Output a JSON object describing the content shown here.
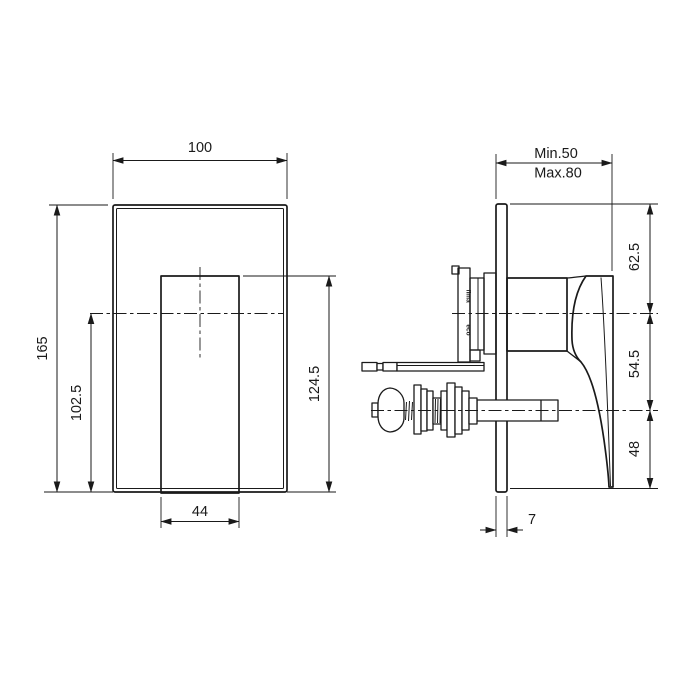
{
  "page": {
    "background_color": "#ffffff",
    "line_color": "#1a1a1a",
    "drawing_type": "shower mixer technical drawing"
  },
  "front_view": {
    "dims": {
      "plate_width": "100",
      "plate_height": "165",
      "handle_width": "44",
      "axis_to_bottom": "102.5",
      "handle_top_to_bottom": "124.5"
    }
  },
  "side_view": {
    "dims": {
      "depth_min": "Min.50",
      "depth_max": "Max.80",
      "plate_top_to_axis": "62.5",
      "axis_to_axis": "54.5",
      "axis_to_bottom": "48",
      "plate_thickness": "7"
    },
    "body_markings": {
      "brand": "fima",
      "series": "eco"
    }
  }
}
